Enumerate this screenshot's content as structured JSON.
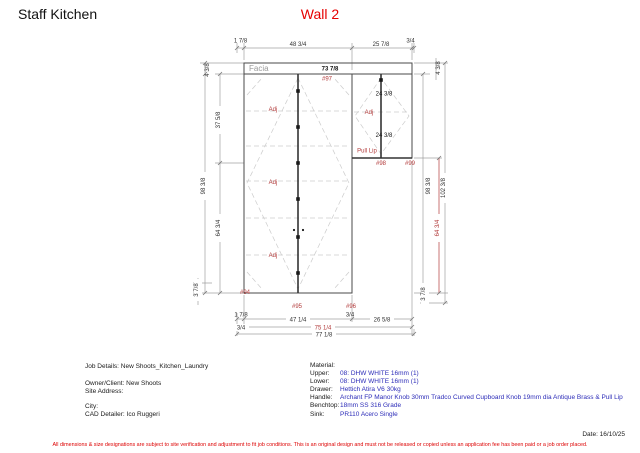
{
  "header": {
    "title": "Staff Kitchen",
    "wall": "Wall 2"
  },
  "drawing": {
    "labels": {
      "facia": "Facia",
      "adj": "Adj",
      "pull_lip": "Pull Lip"
    },
    "items": {
      "i94": "#94",
      "i95": "#95",
      "i96": "#96",
      "i97": "#97",
      "i98": "#98",
      "i99": "#99"
    },
    "dims": {
      "facia_width": "73 7/8",
      "door_width": "24 3/8",
      "top_offset_left": "1 7/8",
      "top_width_left": "48 3/4",
      "top_width_right": "25 7/8",
      "top_offset_right": "3/4",
      "facia_height_left": "4 3/8",
      "upper_height_left": "37 5/8",
      "total_height_left": "98 3/8",
      "lower_height_left": "64 3/4",
      "kick_height_left": "3 7/8",
      "facia_height_right": "4 3/8",
      "total_height_right": "98 3/8",
      "overall_height_right": "102 3/8",
      "lower_height_right": "64 3/4",
      "kick_height_right": "3 7/8",
      "bottom_offset_left": "1 7/8",
      "bottom_width_left": "47 1/4",
      "bottom_offset_mid": "3/4",
      "bottom_width_right": "26 5/8",
      "bottom_offset_left2": "3/4",
      "bottom_width_red": "75 1/4",
      "bottom_width_total": "77 1/8"
    }
  },
  "info": {
    "job_details": "Job Details: New Shoots_Kitchen_Laundry",
    "owner": "Owner/Client: New Shoots",
    "site_address": "Site Address:",
    "city": "City:",
    "cad_detailer": "CAD Detailer: Ico Ruggeri",
    "material_title": "Material:",
    "rows": [
      {
        "label": "Upper:",
        "value": "08: DHW WHITE 16mm (1)"
      },
      {
        "label": "Lower:",
        "value": "08: DHW WHITE 16mm (1)"
      },
      {
        "label": "Drawer:",
        "value": "Hettich Atira V6 30kg"
      },
      {
        "label": "Handle:",
        "value": "Archant FP Manor Knob 30mm Tradco Curved Cupboard Knob 19mm dia Antique Brass & Pull Lip"
      },
      {
        "label": "Benchtop:",
        "value": "18mm SS 316 Grade"
      },
      {
        "label": "Sink:",
        "value": "PR110 Acero Single"
      }
    ]
  },
  "footer": {
    "date": "Date: 16/10/25",
    "disclaimer": "All dimensions & size designations are subject to site verification and adjustment to fit job conditions. This is an original design and must not be released or copied unless an application fee has been paid or a job order placed."
  }
}
